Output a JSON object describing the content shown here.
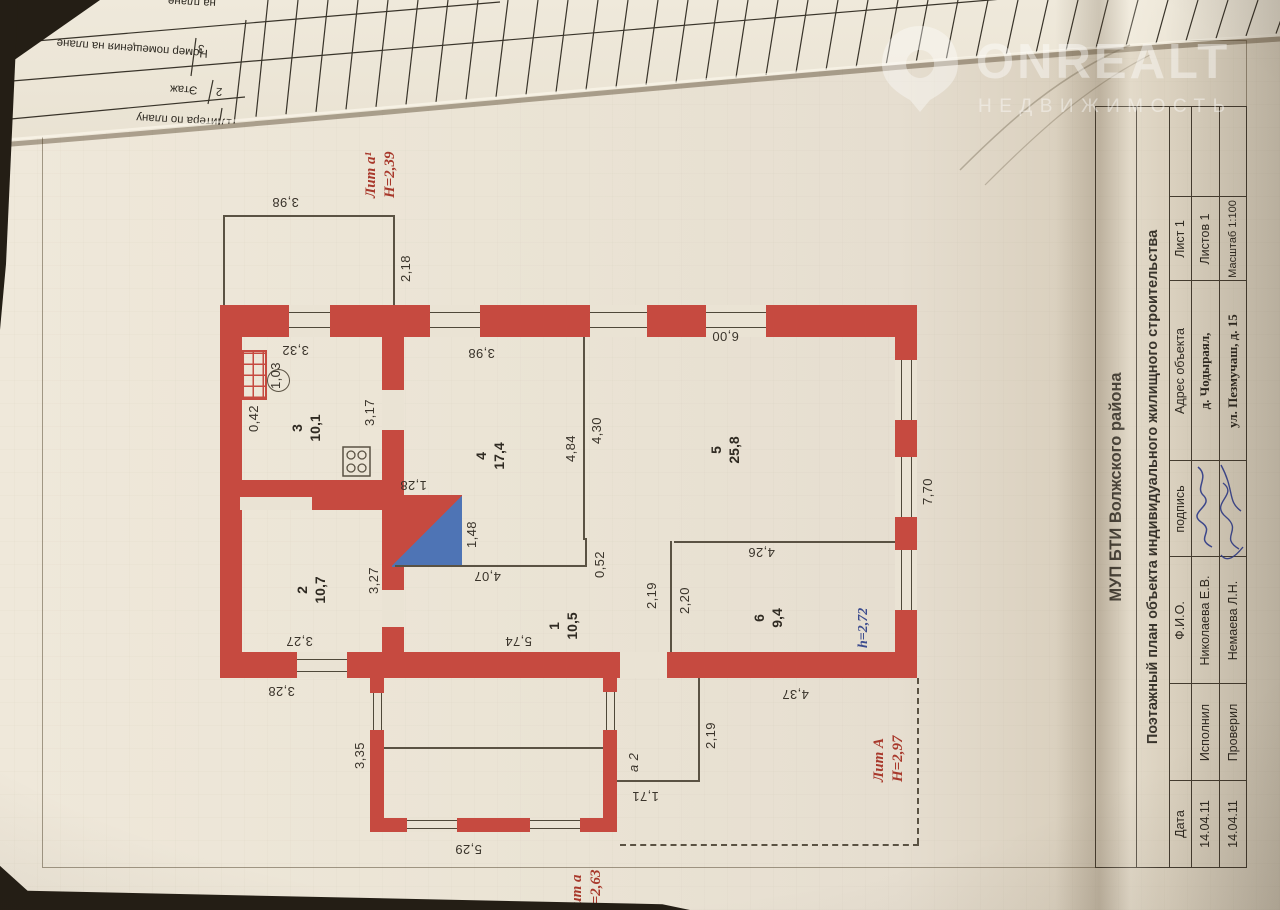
{
  "watermark": {
    "brand": "ONREALT",
    "subtitle": "НЕДВИЖИМОСТЬ"
  },
  "back_page": {
    "row_cut": "на плане",
    "col_object": "Номер помещения на плане",
    "col_object_num": "3",
    "col_floor": "Этаж",
    "col_floor_num": "2",
    "col_litera": "Литера по плану",
    "col_litera_num": "1"
  },
  "plan": {
    "rooms": [
      {
        "num": "1",
        "area": "10,5"
      },
      {
        "num": "2",
        "area": "10,7"
      },
      {
        "num": "3",
        "area": "10,1"
      },
      {
        "num": "4",
        "area": "17,4"
      },
      {
        "num": "5",
        "area": "25,8"
      },
      {
        "num": "6",
        "area": "9,4"
      }
    ],
    "dims": {
      "annex_top": "3,98",
      "annex_side": "2,18",
      "room3_wall": "3,32",
      "stove_w": "1,03",
      "stove_off": "0,42",
      "door34": "3,17",
      "room4_win": "3,98",
      "room5_wall": "6,00",
      "room4_len": "4,84",
      "room5_len": "4,30",
      "pech_w": "1,28",
      "pech_h": "1,48",
      "step": "0,52",
      "room1_w": "4,07",
      "room1_len": "5,74",
      "room2_len": "3,27",
      "room2_wall": "3,27",
      "part16_a": "2,19",
      "part16_b": "2,20",
      "room6_len": "4,26",
      "house_side": "7,70",
      "room2_out": "3,28",
      "annex2_a": "3,35",
      "annex2_len": "5,29",
      "porch_len": "2,19",
      "porch_w": "1,71",
      "house_bottom": "4,37"
    },
    "labels": {
      "lit_a1": "Лит а¹",
      "lit_a1_h": "Н=2,39",
      "lit_A": "Лит А",
      "lit_A_h": "Н=2,97",
      "lit_a": "Лит а",
      "lit_a_h": "Н=2,63",
      "height_mark": "h=2,72",
      "porch_mark": "а 2"
    }
  },
  "title_block": {
    "org": "МУП БТИ Волжского района",
    "doc_title": "Поэтажный план объекта индивидуального жилищного строительства",
    "col_date": "Дата",
    "col_name": "Ф.И.О.",
    "col_sign": "подпись",
    "col_address": "Адрес объекта",
    "sheet": "Лист 1",
    "sheets": "Листов 1",
    "scale": "Масштаб 1:100",
    "address1": "д. Чодыраял,",
    "address2": "ул. Пезмучаш, д. 15",
    "rows": [
      {
        "date": "14.04.11",
        "role": "Исполнил",
        "name": "Николаева Е.В."
      },
      {
        "date": "14.04.11",
        "role": "Проверил",
        "name": "Немаева Л.Н."
      }
    ]
  }
}
